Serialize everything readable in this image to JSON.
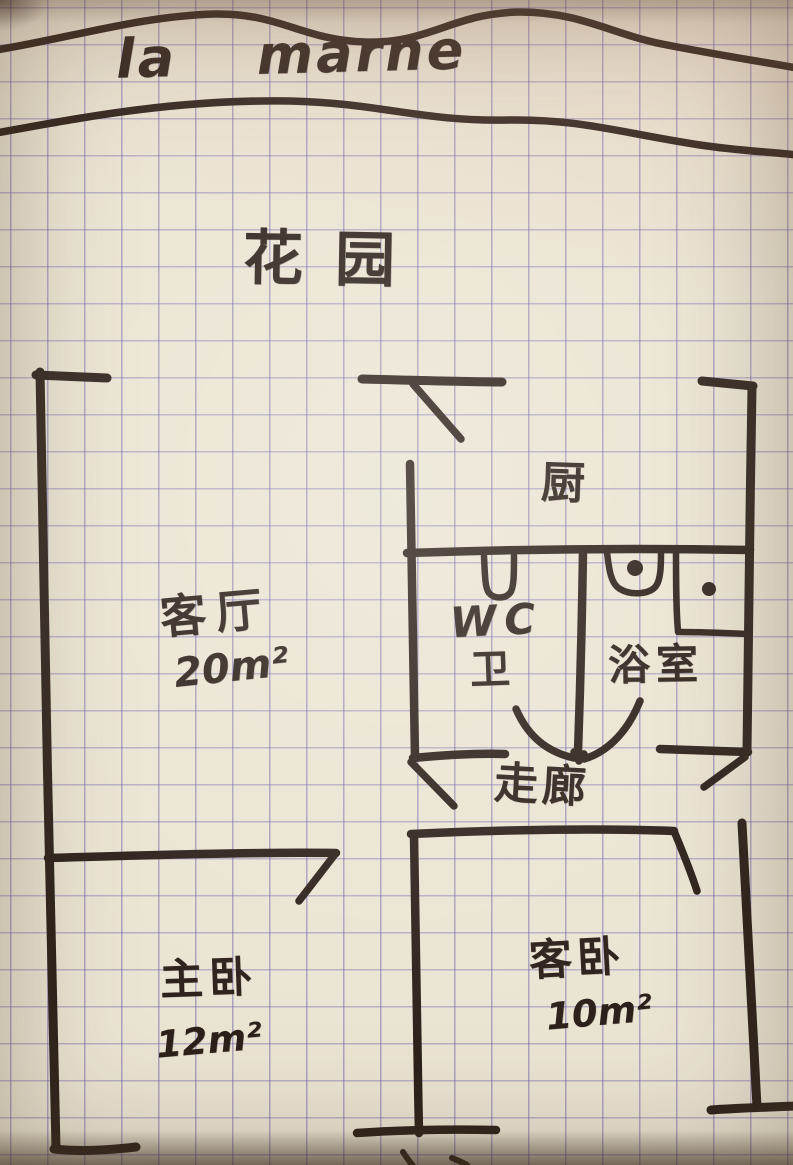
{
  "title": "la marne",
  "outdoor": {
    "garden_label": "花园"
  },
  "rooms": {
    "living_room": {
      "name": "客厅",
      "area": "20m²"
    },
    "kitchen": {
      "name": "厨"
    },
    "wc": {
      "name": "WC",
      "alt_name": "卫"
    },
    "bathroom": {
      "name": "浴室"
    },
    "corridor": {
      "name": "走廊"
    },
    "master_bedroom": {
      "name": "主卧",
      "area": "12m²"
    },
    "guest_bedroom": {
      "name": "客卧",
      "area": "10m²"
    }
  },
  "fixtures": [
    "sink-icon",
    "toilet-icon",
    "drain-icon",
    "entry-arrow-icon"
  ],
  "colors": {
    "pen": "#2c211a",
    "paper": "#eae4d3",
    "grid_line": "#6a5faa"
  }
}
